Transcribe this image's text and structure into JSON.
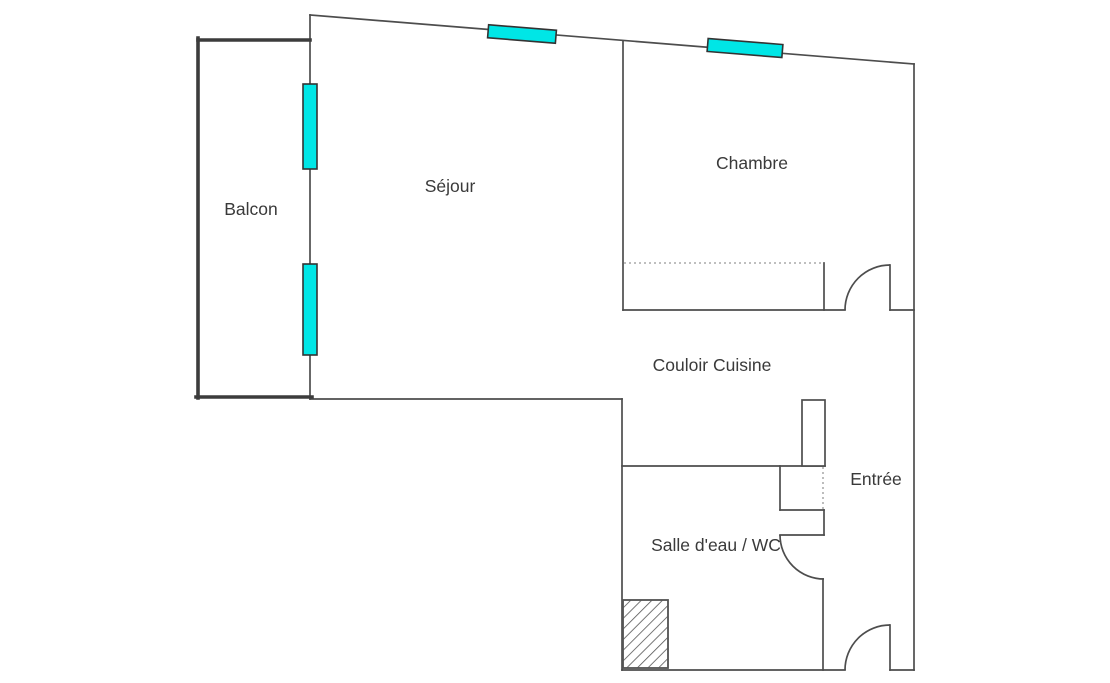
{
  "page": {
    "background": "#ffffff",
    "width": 1110,
    "height": 683
  },
  "plan": {
    "colors": {
      "wall": "#4d4d4d",
      "thick_wall": "#3c3c3c",
      "window_fill": "#00e6e6",
      "window_stroke": "#333333",
      "dotted": "#999999",
      "hatch": "#555555",
      "text": "#3a3a3a",
      "background": "#ffffff"
    },
    "rooms": [
      {
        "name": "balcon",
        "label": "Balcon",
        "x": 251,
        "y": 215
      },
      {
        "name": "sejour",
        "label": "Séjour",
        "x": 450,
        "y": 192
      },
      {
        "name": "chambre",
        "label": "Chambre",
        "x": 752,
        "y": 169
      },
      {
        "name": "couloir-cuisine",
        "label": "Couloir Cuisine",
        "x": 712,
        "y": 371
      },
      {
        "name": "entree",
        "label": "Entrée",
        "x": 876,
        "y": 485
      },
      {
        "name": "salle-eau-wc",
        "label": "Salle d'eau / WC",
        "x": 716,
        "y": 551
      }
    ],
    "walls": [
      {
        "name": "top-exterior-wall-slanted",
        "x1": 310,
        "y1": 15,
        "x2": 914,
        "y2": 64
      },
      {
        "name": "right-exterior-wall",
        "x1": 914,
        "y1": 64,
        "x2": 914,
        "y2": 670
      },
      {
        "name": "bottom-exterior-wall-left",
        "x1": 622,
        "y1": 670,
        "x2": 845,
        "y2": 670
      },
      {
        "name": "bottom-exterior-wall-right",
        "x1": 890,
        "y1": 670,
        "x2": 914,
        "y2": 670
      },
      {
        "name": "bathroom-left-wall",
        "x1": 622,
        "y1": 399,
        "x2": 622,
        "y2": 670
      },
      {
        "name": "sejour-bottom-wall",
        "x1": 310,
        "y1": 399,
        "x2": 622,
        "y2": 399
      },
      {
        "name": "sejour-balcony-wall",
        "x1": 310,
        "y1": 15,
        "x2": 310,
        "y2": 399
      },
      {
        "name": "sejour-chambre-divider",
        "x1": 623,
        "y1": 41,
        "x2": 623,
        "y2": 310
      },
      {
        "name": "chambre-bottom-wall-left",
        "x1": 623,
        "y1": 310,
        "x2": 845,
        "y2": 310
      },
      {
        "name": "chambre-bottom-wall-right",
        "x1": 890,
        "y1": 310,
        "x2": 914,
        "y2": 310
      },
      {
        "name": "chambre-closet-end-wall",
        "x1": 824,
        "y1": 263,
        "x2": 824,
        "y2": 310
      },
      {
        "name": "bathroom-top-wall",
        "x1": 622,
        "y1": 466,
        "x2": 825,
        "y2": 466
      },
      {
        "name": "entree-closet-left-wall",
        "x1": 780,
        "y1": 466,
        "x2": 780,
        "y2": 510
      },
      {
        "name": "entree-closet-bottom-wall",
        "x1": 780,
        "y1": 510,
        "x2": 824,
        "y2": 510
      },
      {
        "name": "bathroom-doorjamb-wall",
        "x1": 824,
        "y1": 510,
        "x2": 824,
        "y2": 535
      },
      {
        "name": "bathroom-door-leaf",
        "x1": 780,
        "y1": 535,
        "x2": 824,
        "y2": 535
      },
      {
        "name": "bathroom-right-wall",
        "x1": 823,
        "y1": 579,
        "x2": 823,
        "y2": 670
      },
      {
        "name": "chambre-door-leaf",
        "x1": 890,
        "y1": 265,
        "x2": 890,
        "y2": 310
      },
      {
        "name": "entree-door-leaf",
        "x1": 890,
        "y1": 625,
        "x2": 890,
        "y2": 670
      }
    ],
    "thick_walls": [
      {
        "name": "balcony-top-wall",
        "x1": 198,
        "y1": 40,
        "x2": 310,
        "y2": 40
      },
      {
        "name": "balcony-left-wall",
        "x1": 198,
        "y1": 38,
        "x2": 198,
        "y2": 398
      },
      {
        "name": "balcony-bottom-wall",
        "x1": 196,
        "y1": 397,
        "x2": 312,
        "y2": 397
      }
    ],
    "dotted_lines": [
      {
        "name": "chambre-closet-dotted-line",
        "x1": 624,
        "y1": 263,
        "x2": 823,
        "y2": 263
      },
      {
        "name": "entree-closet-dotted-line",
        "x1": 823,
        "y1": 467,
        "x2": 823,
        "y2": 510
      }
    ],
    "door_arcs": [
      {
        "name": "chambre-door-arc",
        "d": "M 845 310 A 45 45 0 0 1 890 265"
      },
      {
        "name": "bathroom-door-arc",
        "d": "M 780 535 A 44 44 0 0 0 824 579"
      },
      {
        "name": "entree-door-arc",
        "d": "M 845 670 A 45 45 0 0 1 890 625"
      }
    ],
    "windows_vertical": [
      {
        "name": "balcony-window-upper",
        "x": 303,
        "y": 84,
        "w": 14,
        "h": 85
      },
      {
        "name": "balcony-window-lower",
        "x": 303,
        "y": 264,
        "w": 14,
        "h": 91
      }
    ],
    "windows_rotated": [
      {
        "name": "sejour-top-window",
        "cx": 522,
        "cy": 34,
        "len": 68,
        "th": 13,
        "angle": 4.64
      },
      {
        "name": "chambre-top-window",
        "cx": 745,
        "cy": 48,
        "len": 75,
        "th": 13,
        "angle": 4.64
      }
    ],
    "pillar": {
      "name": "duct-pillar",
      "x": 802,
      "y": 400,
      "w": 23,
      "h": 66
    },
    "hatched_shaft": {
      "name": "technical-shaft-hatched",
      "x": 623,
      "y": 600,
      "w": 45,
      "h": 68
    }
  }
}
